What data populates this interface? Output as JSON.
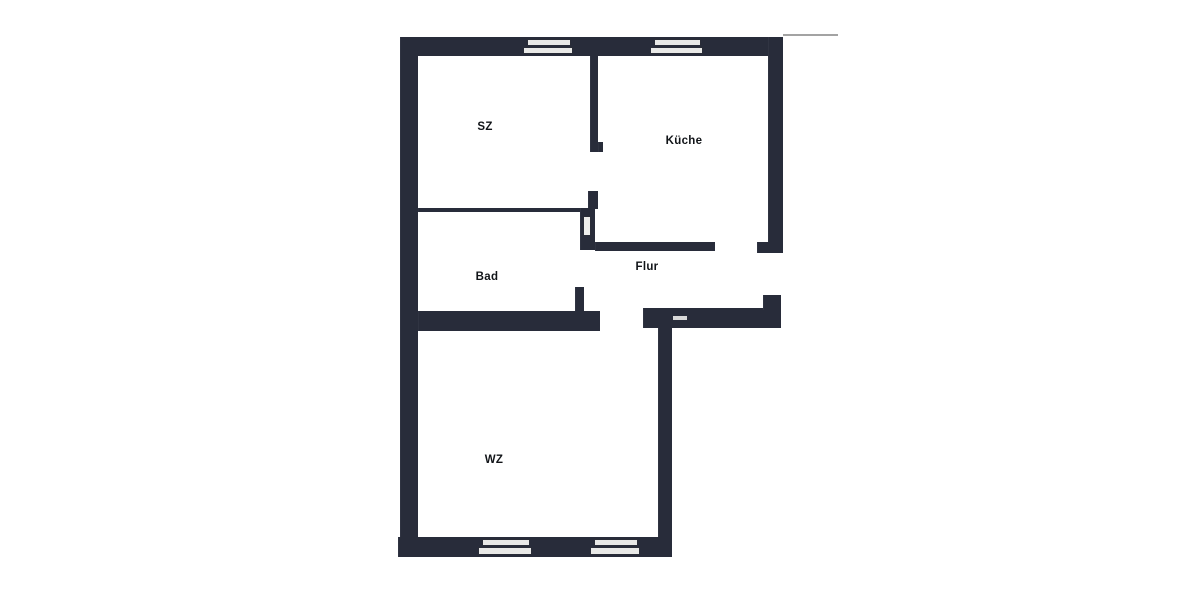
{
  "title": "Grundriss",
  "colors": {
    "wall": "#282c3a",
    "window_fill": "#e9e9e7",
    "window_border": "#2a2d38",
    "label": "#111418",
    "scan_line": "#a3a3a3",
    "background": "#ffffff"
  },
  "floorplan": {
    "rooms": [
      {
        "id": "sz",
        "label": "SZ",
        "x": 485,
        "y": 127
      },
      {
        "id": "kueche",
        "label": "Küche",
        "x": 684,
        "y": 141
      },
      {
        "id": "bad",
        "label": "Bad",
        "x": 487,
        "y": 277
      },
      {
        "id": "flur",
        "label": "Flur",
        "x": 647,
        "y": 267
      },
      {
        "id": "wz",
        "label": "WZ",
        "x": 494,
        "y": 460
      }
    ],
    "walls": [
      {
        "name": "outer-top-wall",
        "x": 400,
        "y": 37,
        "w": 383,
        "h": 19
      },
      {
        "name": "outer-left-wall",
        "x": 400,
        "y": 37,
        "w": 18,
        "h": 508
      },
      {
        "name": "kueche-right-wall",
        "x": 768,
        "y": 37,
        "w": 15,
        "h": 216
      },
      {
        "name": "kueche-right-wall-flange",
        "x": 757,
        "y": 242,
        "w": 26,
        "h": 11
      },
      {
        "name": "sz-kueche-wall",
        "x": 590,
        "y": 56,
        "w": 8,
        "h": 96
      },
      {
        "name": "sz-kueche-wall-foot",
        "x": 598,
        "y": 142,
        "w": 5,
        "h": 10
      },
      {
        "name": "sz-kueche-wall-stub",
        "x": 588,
        "y": 191,
        "w": 10,
        "h": 18
      },
      {
        "name": "bad-top-wall",
        "x": 418,
        "y": 208,
        "w": 164,
        "h": 4
      },
      {
        "name": "bad-door-frame",
        "x": 580,
        "y": 208,
        "w": 15,
        "h": 42
      },
      {
        "name": "flur-top-wall",
        "x": 595,
        "y": 242,
        "w": 120,
        "h": 9
      },
      {
        "name": "bad-door-stub",
        "x": 575,
        "y": 287,
        "w": 9,
        "h": 26
      },
      {
        "name": "bad-bottom-wall",
        "x": 418,
        "y": 311,
        "w": 182,
        "h": 20
      },
      {
        "name": "entrance-wall",
        "x": 643,
        "y": 308,
        "w": 138,
        "h": 20
      },
      {
        "name": "entrance-wall-step",
        "x": 763,
        "y": 295,
        "w": 18,
        "h": 15
      },
      {
        "name": "wz-right-wall",
        "x": 658,
        "y": 328,
        "w": 14,
        "h": 229
      },
      {
        "name": "outer-bottom-wall",
        "x": 398,
        "y": 537,
        "w": 274,
        "h": 20
      }
    ],
    "windows": [
      {
        "name": "window-top-left",
        "x": 523,
        "y": 39,
        "w": 50,
        "h": 15
      },
      {
        "name": "window-top-right",
        "x": 650,
        "y": 39,
        "w": 53,
        "h": 15
      },
      {
        "name": "window-bottom-left",
        "x": 478,
        "y": 539,
        "w": 54,
        "h": 16
      },
      {
        "name": "window-bottom-right",
        "x": 590,
        "y": 539,
        "w": 50,
        "h": 16
      }
    ],
    "door_insert": {
      "name": "bad-door-leaf",
      "x": 583,
      "y": 216,
      "w": 8,
      "h": 20
    },
    "entrance_notch": {
      "name": "entrance-threshold",
      "x": 673,
      "y": 316,
      "w": 14,
      "h": 4
    },
    "scan_line": {
      "name": "scan-artifact-line",
      "x": 783,
      "y": 34,
      "w": 55,
      "h": 2
    }
  }
}
